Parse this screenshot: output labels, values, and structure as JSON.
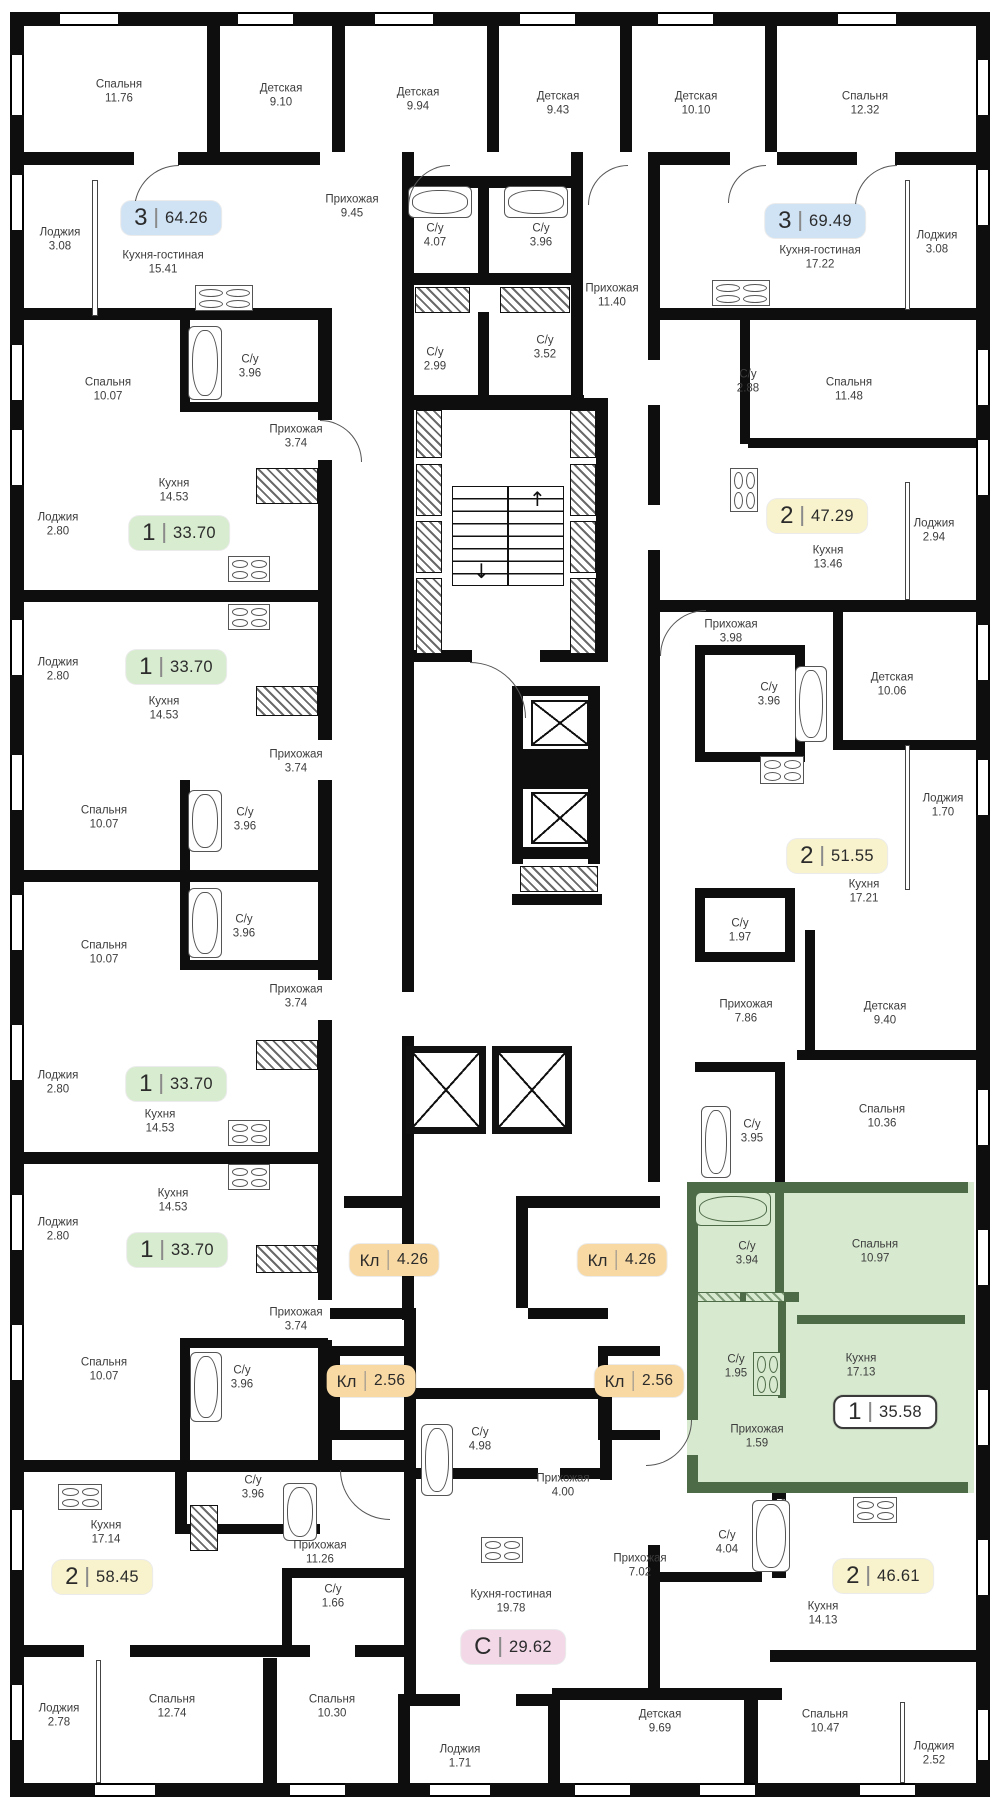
{
  "plan_title": "Residential floor plan",
  "highlight_color": "#d7e9cf",
  "core": {
    "up": "↑",
    "down": "↓"
  },
  "rooms": [
    {
      "name": "Спальня",
      "area": "11.76",
      "x": 119,
      "y": 92
    },
    {
      "name": "Детская",
      "area": "9.10",
      "x": 281,
      "y": 96
    },
    {
      "name": "Детская",
      "area": "9.94",
      "x": 418,
      "y": 100
    },
    {
      "name": "Детская",
      "area": "9.43",
      "x": 558,
      "y": 104
    },
    {
      "name": "Детская",
      "area": "10.10",
      "x": 696,
      "y": 104
    },
    {
      "name": "Спальня",
      "area": "12.32",
      "x": 865,
      "y": 104
    },
    {
      "name": "Лоджия",
      "area": "3.08",
      "x": 60,
      "y": 240
    },
    {
      "name": "Кухня-гостиная",
      "area": "15.41",
      "x": 163,
      "y": 263
    },
    {
      "name": "Прихожая",
      "area": "9.45",
      "x": 352,
      "y": 207
    },
    {
      "name": "С/у",
      "area": "4.07",
      "x": 435,
      "y": 236
    },
    {
      "name": "С/у",
      "area": "3.96",
      "x": 541,
      "y": 236
    },
    {
      "name": "Кухня-гостиная",
      "area": "17.22",
      "x": 820,
      "y": 258
    },
    {
      "name": "Лоджия",
      "area": "3.08",
      "x": 937,
      "y": 243
    },
    {
      "name": "Прихожая",
      "area": "11.40",
      "x": 612,
      "y": 296
    },
    {
      "name": "С/у",
      "area": "2.99",
      "x": 435,
      "y": 360
    },
    {
      "name": "С/у",
      "area": "3.52",
      "x": 545,
      "y": 348
    },
    {
      "name": "С/у",
      "area": "2.88",
      "x": 748,
      "y": 382
    },
    {
      "name": "Спальня",
      "area": "11.48",
      "x": 849,
      "y": 390
    },
    {
      "name": "Спальня",
      "area": "10.07",
      "x": 108,
      "y": 390
    },
    {
      "name": "С/у",
      "area": "3.96",
      "x": 250,
      "y": 367
    },
    {
      "name": "Прихожая",
      "area": "3.74",
      "x": 296,
      "y": 437
    },
    {
      "name": "Кухня",
      "area": "14.53",
      "x": 174,
      "y": 491
    },
    {
      "name": "Лоджия",
      "area": "2.80",
      "x": 58,
      "y": 525
    },
    {
      "name": "Кухня",
      "area": "13.46",
      "x": 828,
      "y": 558
    },
    {
      "name": "Лоджия",
      "area": "2.94",
      "x": 934,
      "y": 531
    },
    {
      "name": "Лоджия",
      "area": "2.80",
      "x": 58,
      "y": 670
    },
    {
      "name": "Кухня",
      "area": "14.53",
      "x": 164,
      "y": 709
    },
    {
      "name": "Прихожая",
      "area": "3.74",
      "x": 296,
      "y": 762
    },
    {
      "name": "Спальня",
      "area": "10.07",
      "x": 104,
      "y": 818
    },
    {
      "name": "С/у",
      "area": "3.96",
      "x": 245,
      "y": 820
    },
    {
      "name": "Прихожая",
      "area": "3.98",
      "x": 731,
      "y": 632
    },
    {
      "name": "С/у",
      "area": "3.96",
      "x": 769,
      "y": 695
    },
    {
      "name": "Детская",
      "area": "10.06",
      "x": 892,
      "y": 685
    },
    {
      "name": "Лоджия",
      "area": "1.70",
      "x": 943,
      "y": 806
    },
    {
      "name": "Кухня",
      "area": "17.21",
      "x": 864,
      "y": 892
    },
    {
      "name": "Спальня",
      "area": "10.07",
      "x": 104,
      "y": 953
    },
    {
      "name": "С/у",
      "area": "3.96",
      "x": 244,
      "y": 927
    },
    {
      "name": "Прихожая",
      "area": "3.74",
      "x": 296,
      "y": 997
    },
    {
      "name": "Лоджия",
      "area": "2.80",
      "x": 58,
      "y": 1083
    },
    {
      "name": "Кухня",
      "area": "14.53",
      "x": 160,
      "y": 1122
    },
    {
      "name": "С/у",
      "area": "1.97",
      "x": 740,
      "y": 931
    },
    {
      "name": "Прихожая",
      "area": "7.86",
      "x": 746,
      "y": 1012
    },
    {
      "name": "Детская",
      "area": "9.40",
      "x": 885,
      "y": 1014
    },
    {
      "name": "Спальня",
      "area": "10.36",
      "x": 882,
      "y": 1117
    },
    {
      "name": "С/у",
      "area": "3.95",
      "x": 752,
      "y": 1132
    },
    {
      "name": "Кухня",
      "area": "14.53",
      "x": 173,
      "y": 1201
    },
    {
      "name": "Лоджия",
      "area": "2.80",
      "x": 58,
      "y": 1230
    },
    {
      "name": "Прихожая",
      "area": "3.74",
      "x": 296,
      "y": 1320
    },
    {
      "name": "Спальня",
      "area": "10.07",
      "x": 104,
      "y": 1370
    },
    {
      "name": "С/у",
      "area": "3.96",
      "x": 242,
      "y": 1378
    },
    {
      "name": "С/у",
      "area": "3.94",
      "x": 747,
      "y": 1254
    },
    {
      "name": "Спальня",
      "area": "10.97",
      "x": 875,
      "y": 1252
    },
    {
      "name": "С/у",
      "area": "1.95",
      "x": 736,
      "y": 1367
    },
    {
      "name": "Кухня",
      "area": "17.13",
      "x": 861,
      "y": 1366
    },
    {
      "name": "Прихожая",
      "area": "1.59",
      "x": 757,
      "y": 1437
    },
    {
      "name": "С/у",
      "area": "4.98",
      "x": 480,
      "y": 1440
    },
    {
      "name": "Прихожая",
      "area": "4.00",
      "x": 563,
      "y": 1486
    },
    {
      "name": "Кухня",
      "area": "17.14",
      "x": 106,
      "y": 1533
    },
    {
      "name": "С/у",
      "area": "3.96",
      "x": 253,
      "y": 1488
    },
    {
      "name": "Прихожая",
      "area": "11.26",
      "x": 320,
      "y": 1553
    },
    {
      "name": "С/у",
      "area": "1.66",
      "x": 333,
      "y": 1597
    },
    {
      "name": "Кухня-гостиная",
      "area": "19.78",
      "x": 511,
      "y": 1602
    },
    {
      "name": "Прихожая",
      "area": "7.02",
      "x": 640,
      "y": 1566
    },
    {
      "name": "С/у",
      "area": "4.04",
      "x": 727,
      "y": 1543
    },
    {
      "name": "Кухня",
      "area": "14.13",
      "x": 823,
      "y": 1614
    },
    {
      "name": "Спальня",
      "area": "12.74",
      "x": 172,
      "y": 1707
    },
    {
      "name": "Лоджия",
      "area": "2.78",
      "x": 59,
      "y": 1716
    },
    {
      "name": "Спальня",
      "area": "10.30",
      "x": 332,
      "y": 1707
    },
    {
      "name": "Лоджия",
      "area": "1.71",
      "x": 460,
      "y": 1757
    },
    {
      "name": "Детская",
      "area": "9.69",
      "x": 660,
      "y": 1722
    },
    {
      "name": "Спальня",
      "area": "10.47",
      "x": 825,
      "y": 1722
    },
    {
      "name": "Лоджия",
      "area": "2.52",
      "x": 934,
      "y": 1754
    }
  ],
  "badges": [
    {
      "type": "3",
      "area": "64.26",
      "x": 171,
      "y": 218,
      "bg": "#cfe3f5",
      "kind": "unit"
    },
    {
      "type": "3",
      "area": "69.49",
      "x": 815,
      "y": 221,
      "bg": "#cfe3f5",
      "kind": "unit"
    },
    {
      "type": "1",
      "area": "33.70",
      "x": 179,
      "y": 533,
      "bg": "#d8eccf",
      "kind": "unit"
    },
    {
      "type": "1",
      "area": "33.70",
      "x": 176,
      "y": 667,
      "bg": "#d8eccf",
      "kind": "unit"
    },
    {
      "type": "1",
      "area": "33.70",
      "x": 176,
      "y": 1084,
      "bg": "#d8eccf",
      "kind": "unit"
    },
    {
      "type": "1",
      "area": "33.70",
      "x": 177,
      "y": 1250,
      "bg": "#d8eccf",
      "kind": "unit"
    },
    {
      "type": "2",
      "area": "47.29",
      "x": 817,
      "y": 516,
      "bg": "#f8f3cc",
      "kind": "unit"
    },
    {
      "type": "2",
      "area": "51.55",
      "x": 837,
      "y": 856,
      "bg": "#f8f3cc",
      "kind": "unit"
    },
    {
      "type": "2",
      "area": "58.45",
      "x": 102,
      "y": 1577,
      "bg": "#f8f3cc",
      "kind": "unit"
    },
    {
      "type": "2",
      "area": "46.61",
      "x": 883,
      "y": 1576,
      "bg": "#f8f3cc",
      "kind": "unit"
    },
    {
      "type": "1",
      "area": "35.58",
      "x": 885,
      "y": 1412,
      "bg": "#ffffff",
      "kind": "unit",
      "outline": true
    },
    {
      "type": "С",
      "area": "29.62",
      "x": 513,
      "y": 1647,
      "bg": "#f3d8e8",
      "kind": "unit"
    },
    {
      "type": "Кл",
      "area": "4.26",
      "x": 394,
      "y": 1260,
      "bg": "#f8d9a4",
      "kind": "storage"
    },
    {
      "type": "Кл",
      "area": "4.26",
      "x": 622,
      "y": 1260,
      "bg": "#f8d9a4",
      "kind": "storage"
    },
    {
      "type": "Кл",
      "area": "2.56",
      "x": 371,
      "y": 1381,
      "bg": "#f8d9a4",
      "kind": "storage"
    },
    {
      "type": "Кл",
      "area": "2.56",
      "x": 639,
      "y": 1381,
      "bg": "#f8d9a4",
      "kind": "storage"
    }
  ]
}
